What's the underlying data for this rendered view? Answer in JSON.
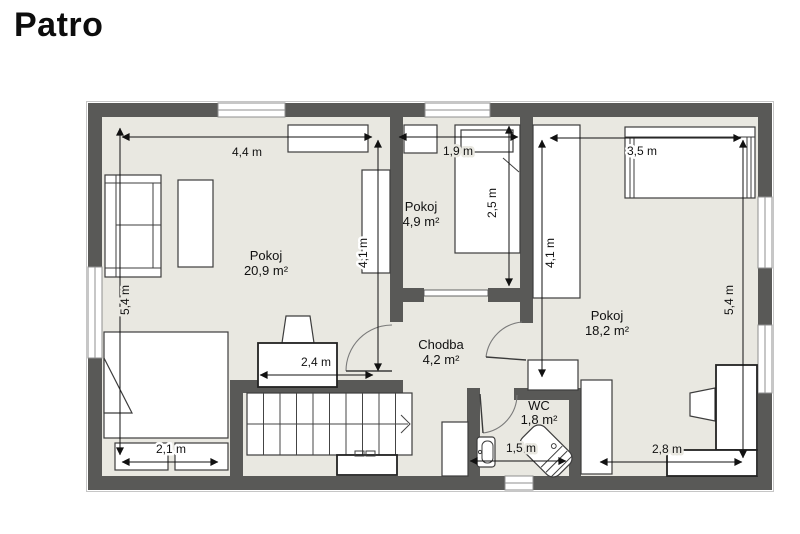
{
  "title": "Patro",
  "floor_plan": {
    "rooms": [
      {
        "name": "Pokoj",
        "area": "20,9 m²"
      },
      {
        "name": "Pokoj",
        "area": "4,9 m²"
      },
      {
        "name": "Pokoj",
        "area": "18,2 m²"
      },
      {
        "name": "Chodba",
        "area": "4,2 m²"
      },
      {
        "name": "WC",
        "area": "1,8 m²"
      }
    ],
    "dimensions": [
      "4,4 m",
      "5,4 m",
      "4,1 m",
      "2,4 m",
      "2,1 m",
      "1,9 m",
      "2,5 m",
      "3,5 m",
      "4,1 m",
      "5,4 m",
      "2,8 m",
      "1,5 m"
    ],
    "colors": {
      "wall": "#595957",
      "floor": "#e9e8e1",
      "furniture": "#ffffff",
      "outline": "#3d3d3d",
      "dimension_text": "#111111"
    }
  }
}
